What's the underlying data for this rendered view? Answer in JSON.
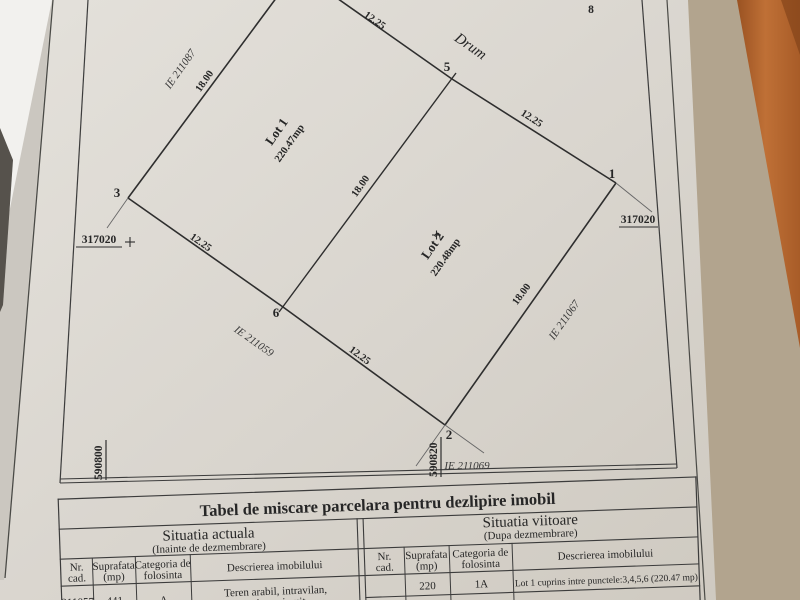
{
  "colors": {
    "background_tan": "#b2a48e",
    "wood": "#a85c28",
    "wood_highlight": "#bf7036",
    "paper_light": "#e4e1db",
    "paper_dark": "#cfcac1",
    "paper_edge_white": "#f2f1ee",
    "shadow_dark": "#56524c",
    "ink": "#2e2e2e"
  },
  "plan": {
    "points": {
      "p1": "1",
      "p2": "2",
      "p3": "3",
      "p5": "5",
      "p6": "6"
    },
    "dims": {
      "edge_3_4": "18.00",
      "edge_4_5": "12.25",
      "edge_5_1": "12.25",
      "edge_1_2": "18.00",
      "edge_2_6": "12.25",
      "edge_6_3": "12.25",
      "divider_5_6": "18.00"
    },
    "road": "Drum",
    "lots": {
      "lot1": {
        "name": "Lot 1",
        "area": "220.47mp"
      },
      "lot2": {
        "name": "Lot 2",
        "area": "220.48mp"
      }
    },
    "neighbors": {
      "top_left": "IE 211087",
      "bottom_left": "IE 211059",
      "right": "IE 211067",
      "bottom": "IE 211069"
    },
    "grid": {
      "x_left": "317020",
      "x_right": "317020",
      "y_bottom_left": "590800",
      "y_bottom_center": "590820"
    },
    "corner_glyph": "8"
  },
  "table": {
    "title": "Tabel de miscare parcelara pentru dezlipire imobil",
    "current": {
      "title": "Situatia actuala",
      "subtitle": "(Inainte de dezmembrare)",
      "col_nr_1": "Nr.",
      "col_nr_2": "cad.",
      "col_sup_1": "Suprafata",
      "col_sup_2": "(mp)",
      "col_cat_1": "Categoria de",
      "col_cat_2": "folosinta",
      "col_desc": "Descrierea imobilului",
      "row": {
        "nr": "211057",
        "suprafata": "441",
        "categoria": "A",
        "desc_line1": "Teren arabil, intravilan,",
        "desc_line2": "neimprejmuit"
      }
    },
    "future": {
      "title": "Situatia viitoare",
      "subtitle": "(Dupa dezmembrare)",
      "col_nr_1": "Nr.",
      "col_nr_2": "cad.",
      "col_sup_1": "Suprafata",
      "col_sup_2": "(mp)",
      "col_cat_1": "Categoria de",
      "col_cat_2": "folosinta",
      "col_desc": "Descrierea imobilului",
      "row": {
        "nr": "",
        "suprafata": "220",
        "categoria": "1A",
        "desc": "Lot 1 cuprins intre punctele:3,4,5,6 (220.47 mp)"
      }
    }
  }
}
